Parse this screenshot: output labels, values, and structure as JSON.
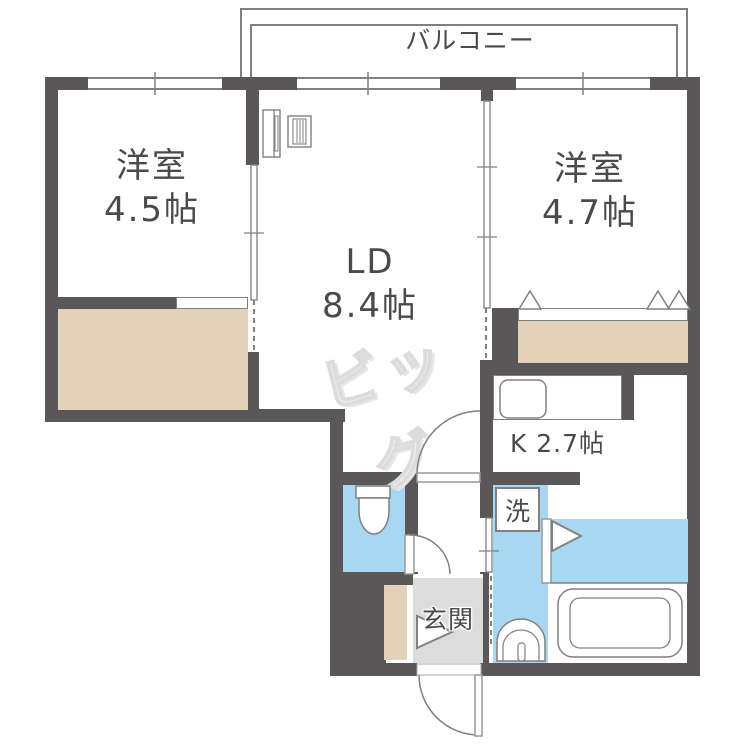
{
  "floorplan": {
    "balcony": {
      "label": "バルコニー"
    },
    "rooms": {
      "bedroom_left": {
        "name": "洋室",
        "size": "4.5帖"
      },
      "bedroom_right": {
        "name": "洋室",
        "size": "4.7帖"
      },
      "living_dining": {
        "name": "LD",
        "size": "8.4帖"
      },
      "kitchen": {
        "label": "K 2.7帖"
      },
      "entrance": {
        "label": "玄関"
      },
      "laundry": {
        "label": "洗"
      }
    },
    "watermark": {
      "text": "ビッグ"
    },
    "colors": {
      "wall": "#595757",
      "line": "#808080",
      "water_area": "#a8d7f2",
      "closet": "#e3d2ba",
      "entrance_floor": "#dcdcdc",
      "text": "#4a4a4a",
      "watermark": "#f1f1f1"
    }
  }
}
